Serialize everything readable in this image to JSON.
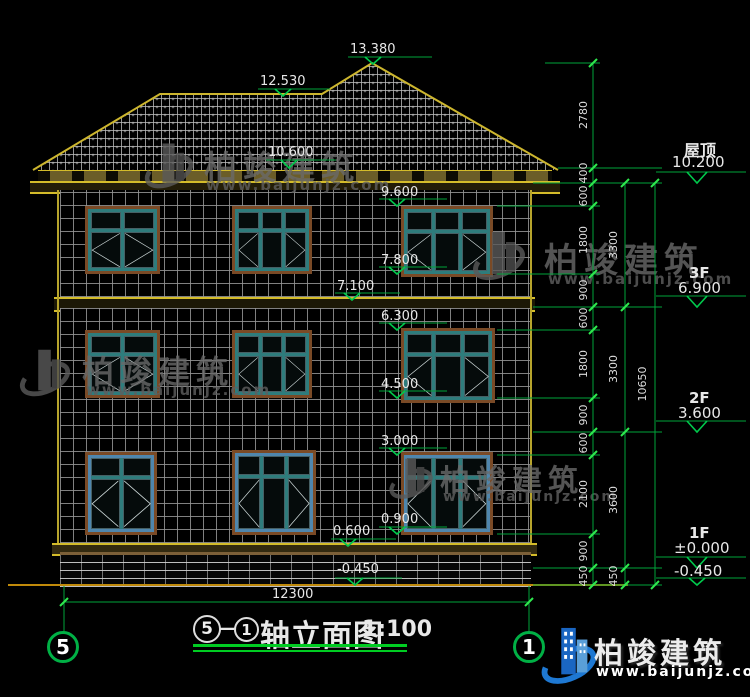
{
  "drawing": {
    "title": {
      "axis_start": "5",
      "dash": "—",
      "axis_end": "1",
      "name": "轴立面图",
      "scale": "1:100"
    },
    "bottom_dimension": "12300",
    "axis_bubbles": {
      "left": "5",
      "right": "1"
    },
    "elevation_markers": {
      "m13380": "13.380",
      "m12530": "12.530",
      "m10600": "10.600",
      "m9600": "9.600",
      "m7800": "7.800",
      "m7100": "7.100",
      "m6300": "6.300",
      "m4500": "4.500",
      "m3000": "3.000",
      "m0900": "0.900",
      "m0600": "0.600",
      "mneg0450": "-0.450"
    },
    "floor_levels": [
      {
        "label": "屋顶",
        "elev": "10.200"
      },
      {
        "label": "3F",
        "elev": "6.900"
      },
      {
        "label": "2F",
        "elev": "3.600"
      },
      {
        "label": "1F",
        "elev": "±0.000"
      },
      {
        "label": "",
        "elev": "-0.450"
      }
    ],
    "dims": {
      "inner": [
        "2780",
        "400",
        "600",
        "1800",
        "900",
        "600",
        "1800",
        "900",
        "600",
        "2100",
        "900",
        "450"
      ],
      "middle": [
        "3300",
        "3300",
        "3600",
        "450"
      ],
      "total": "10650"
    },
    "colors": {
      "dimension_green": "#00a33a",
      "outline_yellow": "#cdb62e",
      "window_teal": "#2e7c7c",
      "text_white": "#e8e8e8"
    }
  },
  "watermark": {
    "name": "柏竣建筑",
    "url": "www.baijunjz.com"
  },
  "logo": {
    "name": "柏竣建筑",
    "url": "www.baijunjz.com"
  }
}
